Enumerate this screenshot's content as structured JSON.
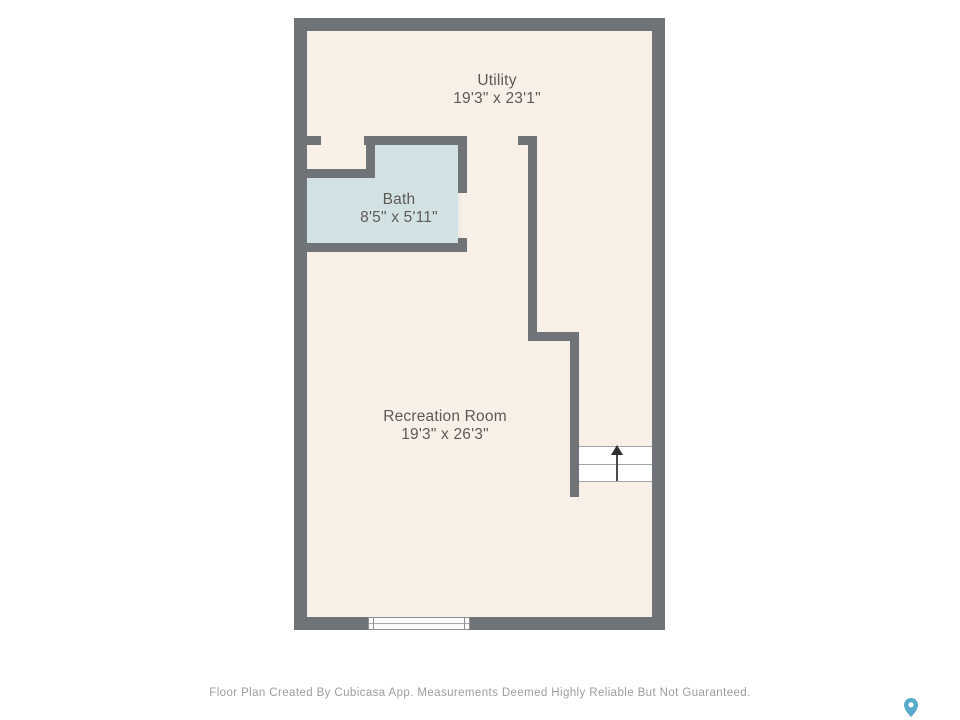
{
  "floor_plan": {
    "rooms": [
      {
        "name": "Utility",
        "dimensions": "19'3\" x 23'1\""
      },
      {
        "name": "Bath",
        "dimensions": "8'5\" x 5'11\""
      },
      {
        "name": "Recreation Room",
        "dimensions": "19'3\" x 26'3\""
      }
    ],
    "stairs": {
      "direction": "up",
      "visible_treads": "2"
    },
    "footer_text": "Floor Plan Created By Cubicasa App. Measurements Deemed Highly Reliable But Not Guaranteed.",
    "colors": {
      "wall": "#707377",
      "floor": "#f8efe6",
      "bath_floor": "#d2e2e4",
      "stairs_fill": "#ffffff",
      "label_text": "#5d5a56",
      "footer_text": "#9d9d9d",
      "brand_pin": "#58abcd",
      "page_background": "#ffffff"
    }
  }
}
